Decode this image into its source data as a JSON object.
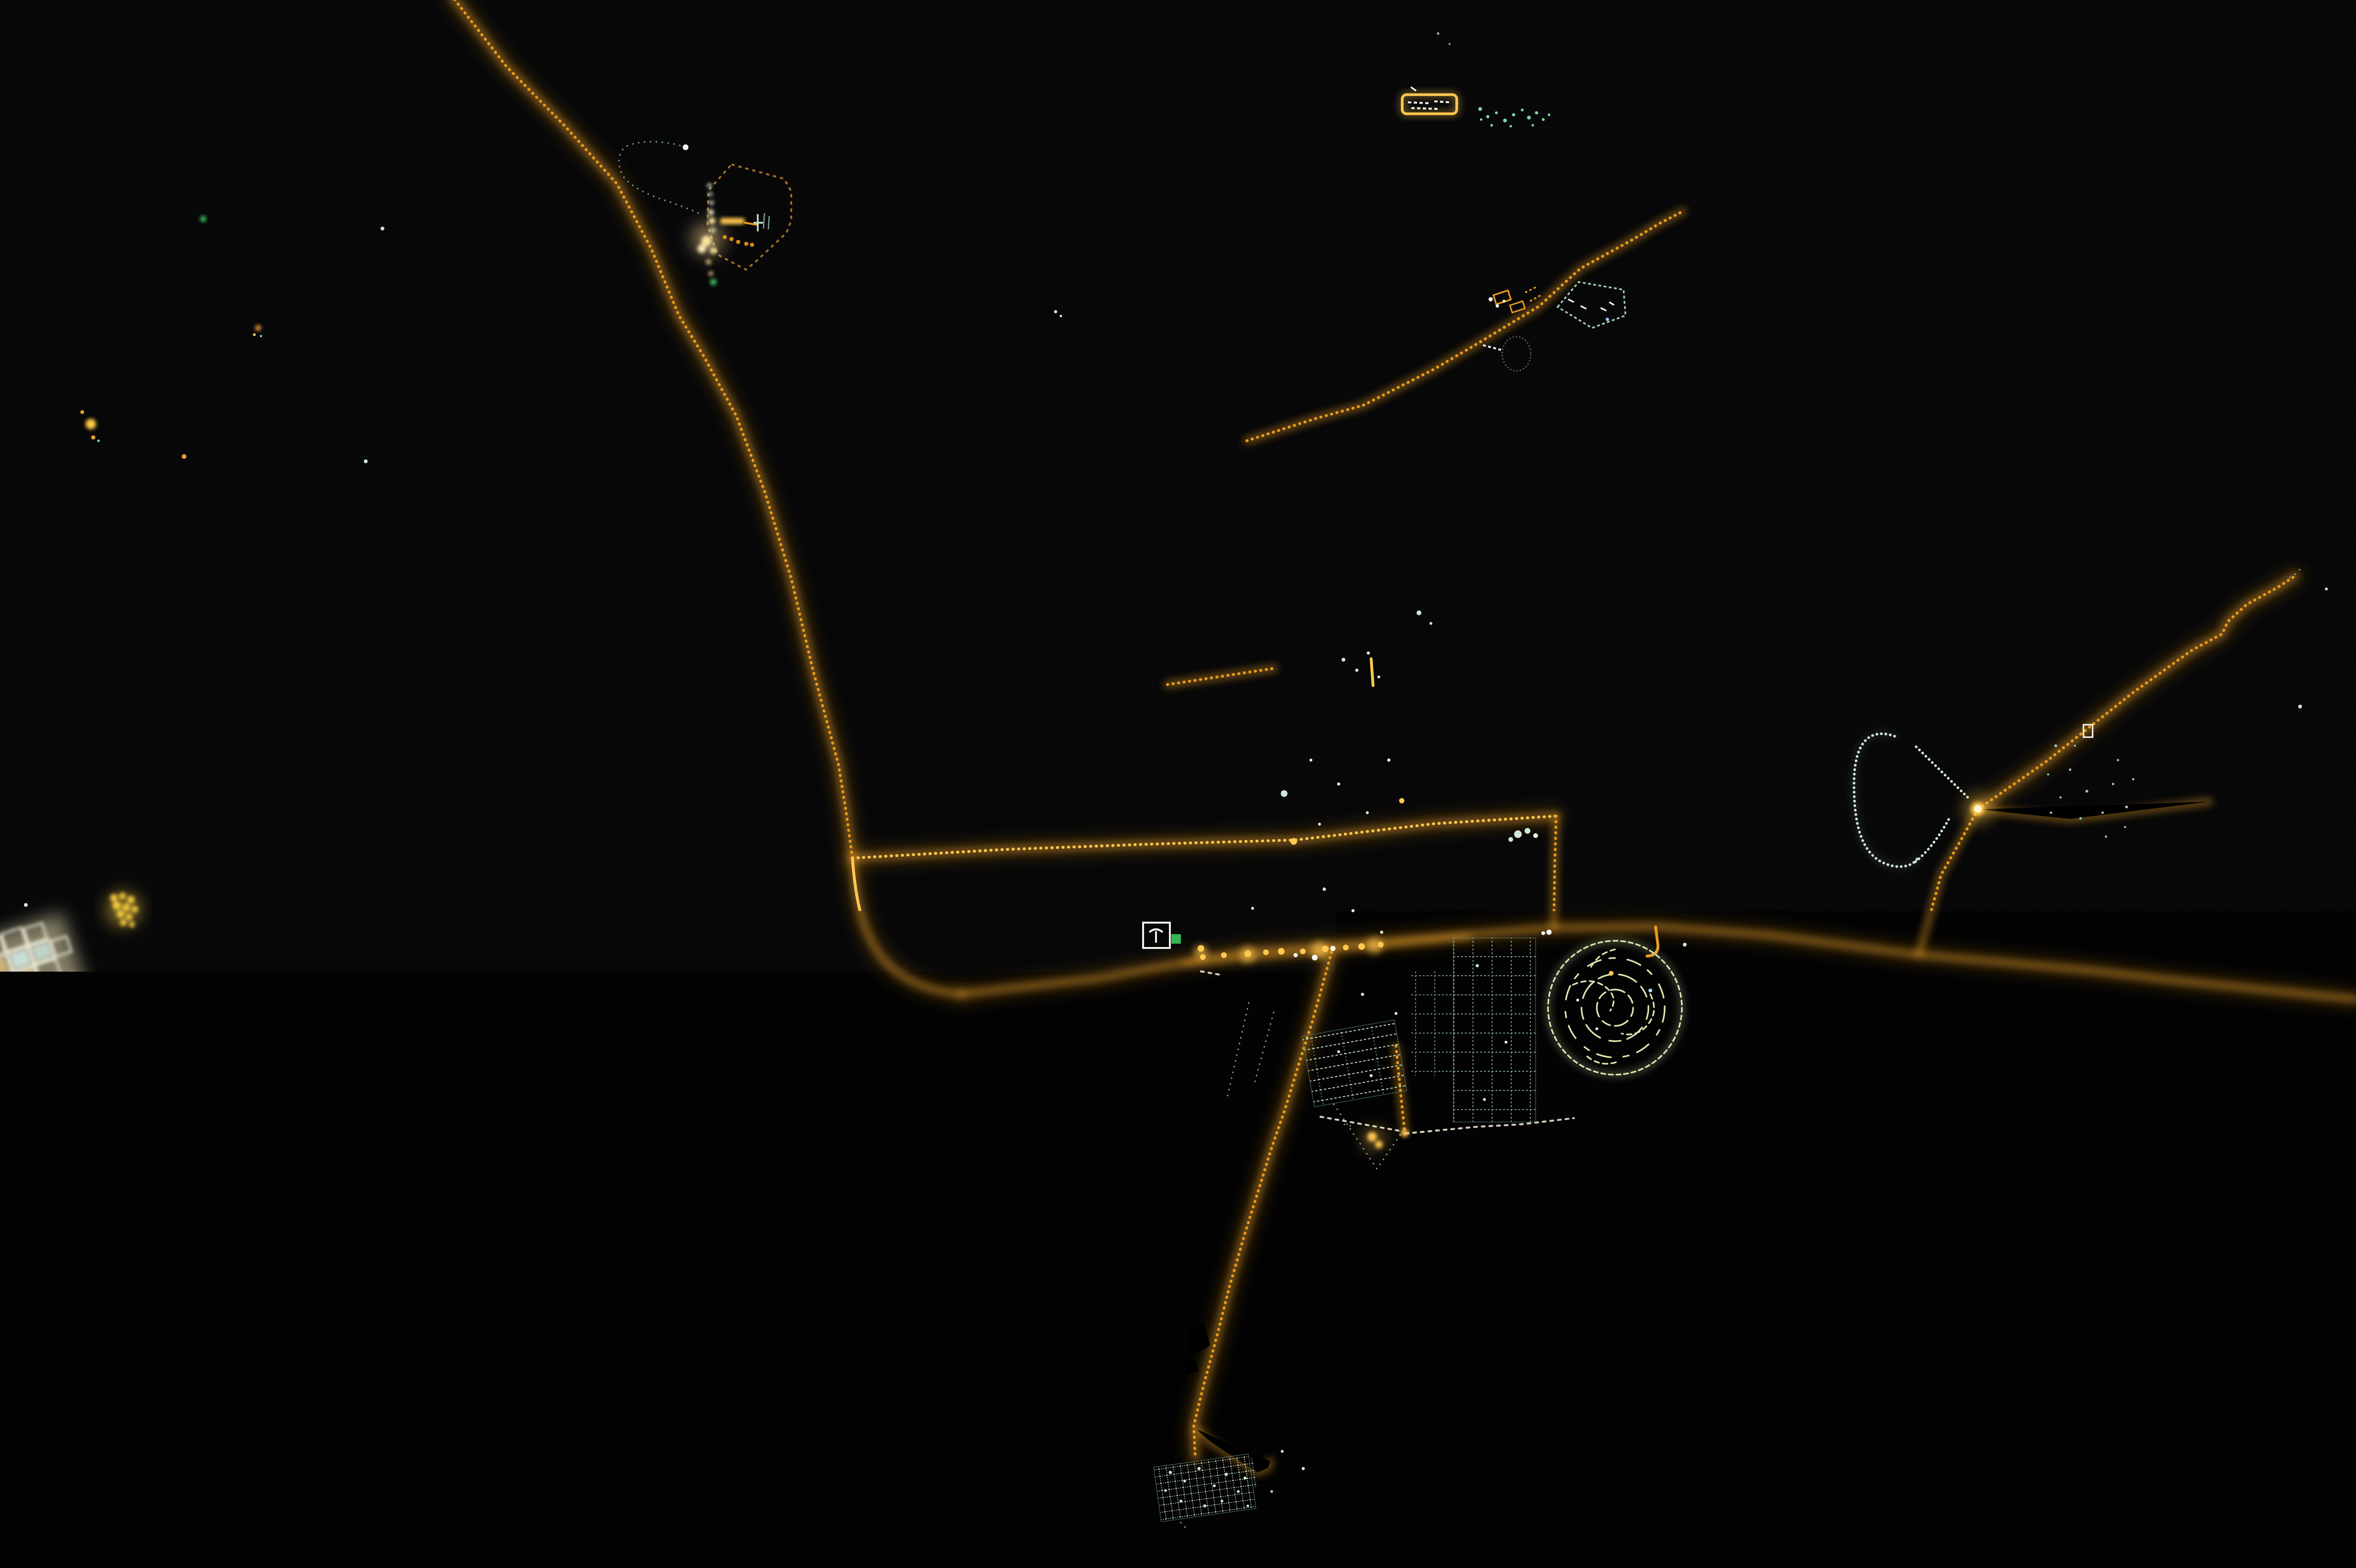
{
  "meta": {
    "title": "Nighttime satellite photograph of a desert city",
    "description": "Astronaut night photograph of an isolated desert city: amber sodium-lit highways radiate from a teal grid-patterned town; a circular maze-like district sits east of the center, a teardrop loop road further east, industrial facilities glow to the northwest, northeast and south, and small clusters of lights are scattered across the black desert."
  },
  "colors": {
    "bg": "#030304",
    "orange": "#e89b1c",
    "orange-bright": "#ffc850",
    "orange-dim": "#a06f22",
    "amber-glow": "#f5a623",
    "gold": "#f2c83e",
    "teal": "#cfe8d4",
    "teal-mid": "#9cc9b2",
    "teal-dim": "#5f8a78",
    "cream": "#ece8d6",
    "sage": "#93b989",
    "maze": "#d9e5ac",
    "green": "#3fd45f",
    "blue": "#4a6cf0",
    "red": "#c04038",
    "white": "#f2f4ee"
  },
  "features": [
    {
      "name": "long-highway-north",
      "desc": "dotted amber highway entering at top, curving past NW facility down to the western junction"
    },
    {
      "name": "main-road-east",
      "desc": "main amber artery running west-east through the city center to the right edge"
    },
    {
      "name": "upper-parallel-road",
      "desc": "second amber road splitting from the western junction, running above the city, cornering down at its east end"
    },
    {
      "name": "city-top-road",
      "desc": "short amber L-shaped road at the north edge of the city grid"
    },
    {
      "name": "northeast-road",
      "desc": "amber road climbing northeast past an industrial strip and a pentagon-shaped compound"
    },
    {
      "name": "sage-track",
      "desc": "thin sage-green wavy track linking the northeast road to the top of the city grid"
    },
    {
      "name": "city-grids",
      "desc": "pale teal street grids of the town, several rectangular districts north and south of the main road"
    },
    {
      "name": "city-center-lights",
      "desc": "dense bright amber and white lights along the main road downtown"
    },
    {
      "name": "maze-circle",
      "desc": "circular district of curving pale yellow-green lanes east of the city"
    },
    {
      "name": "teardrop-loop",
      "desc": "pale teal teardrop loop road west of the bright eastern interchange"
    },
    {
      "name": "eastern-interchange",
      "desc": "glowing amber junction with branches northeast, east and south to the main road"
    },
    {
      "name": "northeast-branch-road",
      "desc": "dotted amber branch running toward the top-right corner, fading out"
    },
    {
      "name": "southwest-road",
      "desc": "dotted amber road running from downtown south-southwest to the southern facility"
    },
    {
      "name": "south-facility",
      "desc": "tilted teal-speckled compound at the bottom joined by the southwest road"
    },
    {
      "name": "nw-facility",
      "desc": "industrial plant NW: tilted dim-orange ring with a column of brilliant white lights and an orange flare bar"
    },
    {
      "name": "nw-facility-loop",
      "desc": "dotted teal teardrop loop on the west side of the NW facility"
    },
    {
      "name": "top-right-compound",
      "desc": "small orange-outlined rectangular compound near the top with white interior lights and green scatter to its right"
    },
    {
      "name": "pentagon-compound",
      "desc": "teal pentagon-outlined compound beside the northeast road"
    },
    {
      "name": "west-town",
      "desc": "bright tilted block-grid settlement at the left edge, warm white and teal cells"
    },
    {
      "name": "west-yellow-cluster",
      "desc": "dense knot of yellow lights above the west town"
    },
    {
      "name": "southwest-clusters",
      "desc": "loose gold, teal and blue light clusters in the lower-left corner"
    },
    {
      "name": "stadium-compound",
      "desc": "white-outlined stadium block and multicolored sports compound west of downtown"
    },
    {
      "name": "south-junction",
      "desc": "amber glow where a south road meets white connector roads below the city"
    },
    {
      "name": "scattered-lights",
      "desc": "isolated green, teal and orange pinpoint lights across the desert"
    }
  ]
}
